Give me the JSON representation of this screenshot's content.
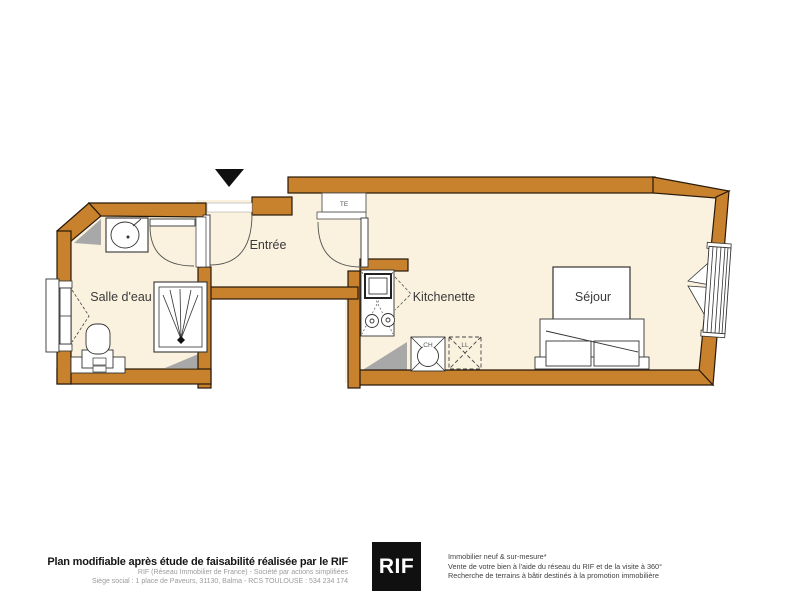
{
  "plan": {
    "labels": {
      "bathroom": "Salle d'eau",
      "entrance": "Entrée",
      "kitchenette": "Kitchenette",
      "living_room": "Séjour",
      "electrical_panel": "TE",
      "water_heater": "CH",
      "washing_machine": "LL"
    }
  },
  "footer": {
    "left": {
      "headline": "Plan modifiable après étude de faisabilité réalisée par le RIF",
      "line1": "RIF (Réseau Immobilier de France) - Société par actions simplifiées",
      "line2": "Siège social : 1 place de Paveurs, 31130, Balma - RCS TOULOUSE : 534 234 174"
    },
    "logo": {
      "text": "RIF"
    },
    "right": {
      "line1": "Immobilier neuf & sur-mesure*",
      "line2": "Vente de votre bien à l'aide du réseau du RIF et de la visite à 360°",
      "line3": "Recherche de terrains à bâtir destinés à la promotion immobilière"
    }
  },
  "colors": {
    "wall": "#C8812C",
    "wall_outline": "#27190a",
    "floor": "#FAF2DE",
    "poche_gray": "#A8A8A8",
    "logo_background": "#101010"
  }
}
